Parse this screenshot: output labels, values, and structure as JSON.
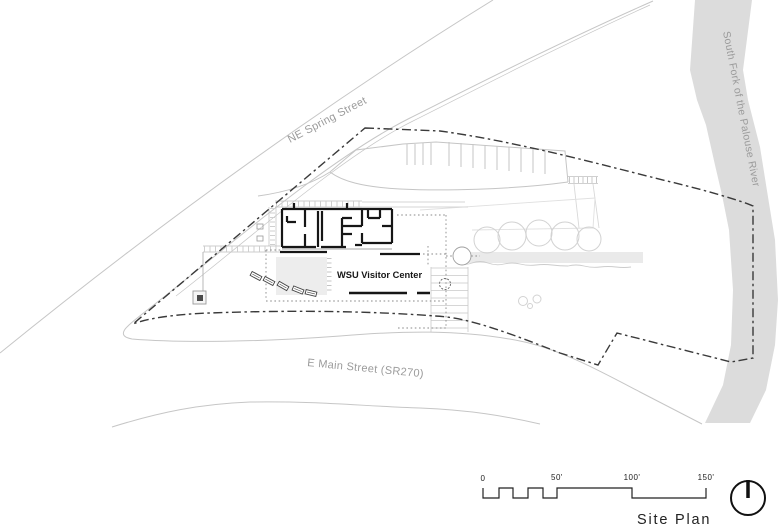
{
  "drawing": {
    "title": "Site Plan",
    "building_label": "WSU Visitor Center",
    "streets": {
      "ne_spring": "NE Spring Street",
      "e_main": "E Main Street (SR270)"
    },
    "river_label": "South Fork of the Palouse River",
    "scale_bar": {
      "tick_0": "0",
      "tick_50": "50'",
      "tick_100": "100'",
      "tick_150": "150'"
    },
    "icons": {
      "north_arrow": "north-arrow"
    },
    "colors": {
      "road_line": "#c6c6c6",
      "river_fill": "#dcdcdc",
      "boundary_line": "#3a3a3a",
      "building_ink": "#161616",
      "label_gray": "#9b9b9b",
      "title_ink": "#222222"
    }
  }
}
